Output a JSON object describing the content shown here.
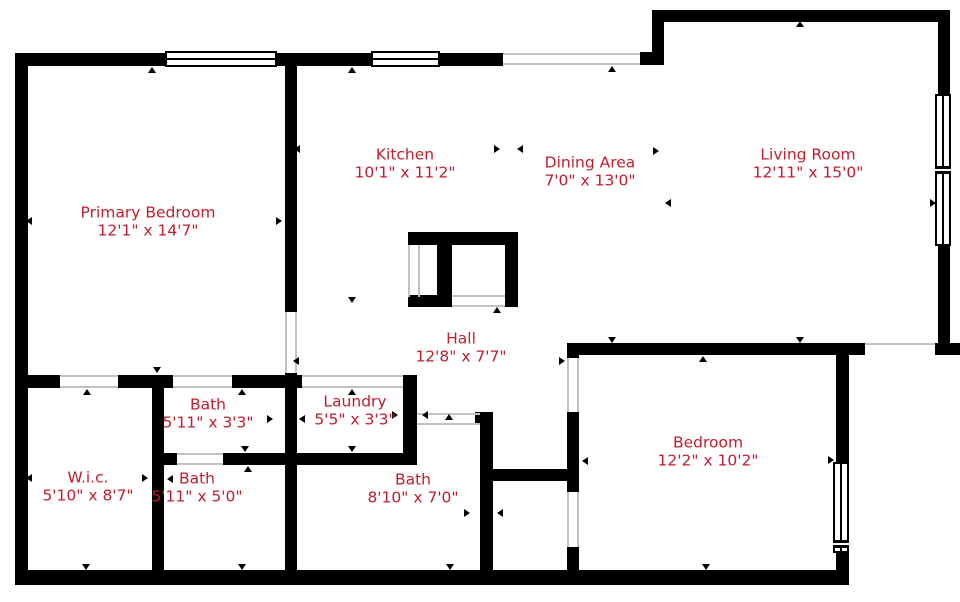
{
  "plan_title": "Floor plan",
  "colors": {
    "label_text": "#bf1e2e",
    "wall": "#000000",
    "opening_line": "#c2c2c2",
    "background": "#ffffff"
  },
  "rooms": [
    {
      "id": "primary-bedroom",
      "name": "Primary Bedroom",
      "dims": "12'1\" x 14'7\"",
      "label_x": 148,
      "label_y": 222
    },
    {
      "id": "kitchen",
      "name": "Kitchen",
      "dims": "10'1\" x 11'2\"",
      "label_x": 405,
      "label_y": 164
    },
    {
      "id": "dining-area",
      "name": "Dining Area",
      "dims": "7'0\" x 13'0\"",
      "label_x": 590,
      "label_y": 172
    },
    {
      "id": "living-room",
      "name": "Living Room",
      "dims": "12'11\" x 15'0\"",
      "label_x": 808,
      "label_y": 164
    },
    {
      "id": "hall",
      "name": "Hall",
      "dims": "12'8\" x 7'7\"",
      "label_x": 461,
      "label_y": 348
    },
    {
      "id": "bath-upper",
      "name": "Bath",
      "dims": "5'11\" x 3'3\"",
      "label_x": 208,
      "label_y": 414
    },
    {
      "id": "laundry",
      "name": "Laundry",
      "dims": "5'5\" x 3'3\"",
      "label_x": 355,
      "label_y": 411
    },
    {
      "id": "wic",
      "name": "W.i.c.",
      "dims": "5'10\" x 8'7\"",
      "label_x": 88,
      "label_y": 487
    },
    {
      "id": "bath-middle",
      "name": "Bath",
      "dims": "5'11\" x 5'0\"",
      "label_x": 197,
      "label_y": 488
    },
    {
      "id": "bath-lower",
      "name": "Bath",
      "dims": "8'10\" x 7'0\"",
      "label_x": 413,
      "label_y": 489
    },
    {
      "id": "bedroom",
      "name": "Bedroom",
      "dims": "12'2\" x 10'2\"",
      "label_x": 708,
      "label_y": 452
    }
  ]
}
